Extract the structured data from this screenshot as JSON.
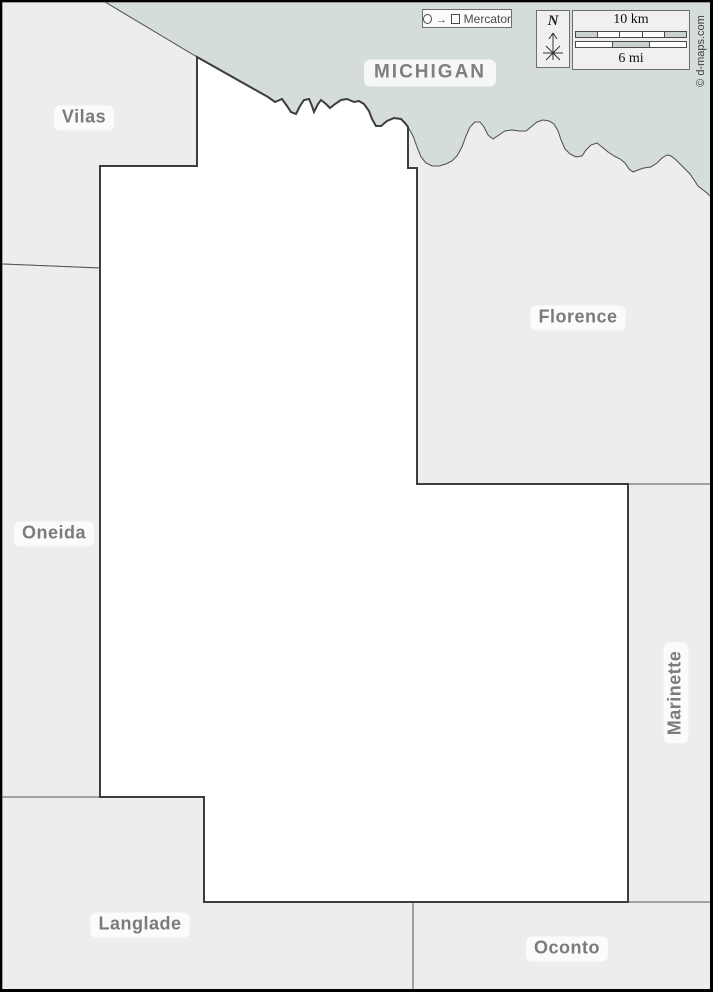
{
  "regions": {
    "michigan": {
      "label": "MICHIGAN"
    },
    "vilas": {
      "label": "Vilas"
    },
    "oneida": {
      "label": "Oneida"
    },
    "florence": {
      "label": "Florence"
    },
    "marinette": {
      "label": "Marinette"
    },
    "langlade": {
      "label": "Langlade"
    },
    "oconto": {
      "label": "Oconto"
    }
  },
  "legend": {
    "projection_label": "Mercator",
    "compass_north_label": "N",
    "scale_top_label": "10 km",
    "scale_bottom_label": "6 mi"
  },
  "credit_text": "© d-maps.com",
  "colors": {
    "michigan_fill": "#d4ddd9",
    "neighbor_county_fill": "#ededed",
    "focus_county_fill": "#ffffff",
    "border_line": "#555555",
    "focus_border_line": "#3d3d3d",
    "label_text": "#7b7b7b",
    "frame": "#000000",
    "scale_segment_fill": "#c9d2cd"
  }
}
